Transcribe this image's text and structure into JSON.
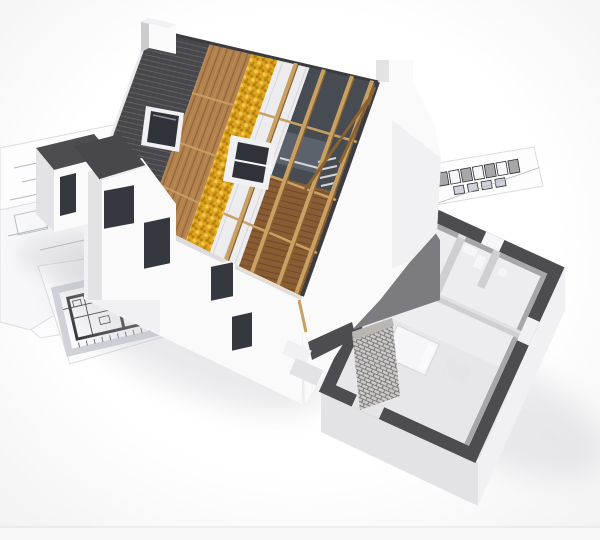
{
  "scene": {
    "type": "3d-architectural-render",
    "description": "Cutaway 3D model of a house under construction standing on architectural blueprint sheets",
    "parts": {
      "blueprints": "blueprint sheets with floor plan and elevation drawings",
      "floor_plan_drawing": "bold floor plan drawing on sheet",
      "elevation_strip": "row of small elevation drawings on sheet",
      "garage_wing": "small white wing with dark flat roof and window slit",
      "cross_wing": "front cross-gable wing with window and door openings",
      "facade": "white front facade under the eave",
      "roof_tiles": "dark grey roof tile layer with closed skylight",
      "roof_sheathing": "brown wood sheathing layer",
      "roof_insulation": "yellow mineral-wool insulation layer",
      "roof_boards": "white sarking boards with battens",
      "roof_framing": "open timber rafters, purlins and braces",
      "attic": "exposed attic interior with plank floor",
      "skylight_closed": "closed roof window in tile layer",
      "skylight_open": "open roof window frame",
      "chimney": "white chimney at ridge",
      "gable_wall": "white Dutch gable end wall with chimney top",
      "extension_plan": "exposed single-storey floor plan with dark cut wall tops",
      "kitchen": "kitchen units and counter",
      "bathroom": "bathroom fixtures",
      "bed": "white bed slab",
      "brick_pillar": "exposed block-work wall section",
      "ground": "white ground plane with soft shadows"
    }
  },
  "palette": {
    "bg1": "#ffffff",
    "bg2": "#f0f0f1",
    "sheet": "#fdfdfe",
    "sheetShade": "#f7f7f9",
    "sheetEdge": "#dcdde0",
    "sheetLine": "#b3b9c3",
    "planBold": "#2e2e33",
    "planGray": "#d0d3d9",
    "grayBand": "#d6d8dc",
    "tile": "#48484c",
    "tileLine": "#5f5f64",
    "tileRidge": "#3c3c40",
    "verge": "#ececee",
    "wood": "#b2824e",
    "woodLine": "#8a5c30",
    "woodLight": "#c69461",
    "insul": "#dda31e",
    "insulDark": "#b17d0d",
    "insulLight": "#f2c94e",
    "timber": "#c9a163",
    "timberDark": "#8a6335",
    "board": "#ededef",
    "boardLine": "#d6d6d9",
    "atticDark": "#474b52",
    "atticSlab": "#5c626c",
    "plank": "#8a5c34",
    "plankLine": "#6c4523",
    "white": "#fafafb",
    "wallLight": "#f1f1f3",
    "wallShade": "#e3e3e6",
    "wallShadow": "#cbcbd0",
    "opening": "#35383e",
    "glass": "#2f3238",
    "glassHi": "#8a9099",
    "wallTop": "#4d4d51",
    "intWall": "#cfcfd3",
    "intWallLight": "#e1e1e4",
    "intShadow": "#a6a6ab",
    "floor": "#ededef",
    "floorShade": "#e5e5e8",
    "cabinet": "#d7d7db",
    "cabinetDark": "#9b9ba0",
    "unit": "#8e8e93",
    "unitTop": "#aaaaae",
    "counter": "#e9e9ec",
    "counterFront": "#d5d5d9",
    "brick": "#ccc9c6",
    "mortar": "#7a787c",
    "brickTop": "#b9b6b3",
    "fascia": "#dcdcdf",
    "floorEdge": "#e9dfce",
    "shadow": "#bdbdc4",
    "strip": "#f8f8f9",
    "stripLine": "#e3e3e5",
    "fixture": "#f6f6f8",
    "darkFloor": "#7b7b80",
    "darkWallFace": "#5a5a5f"
  }
}
